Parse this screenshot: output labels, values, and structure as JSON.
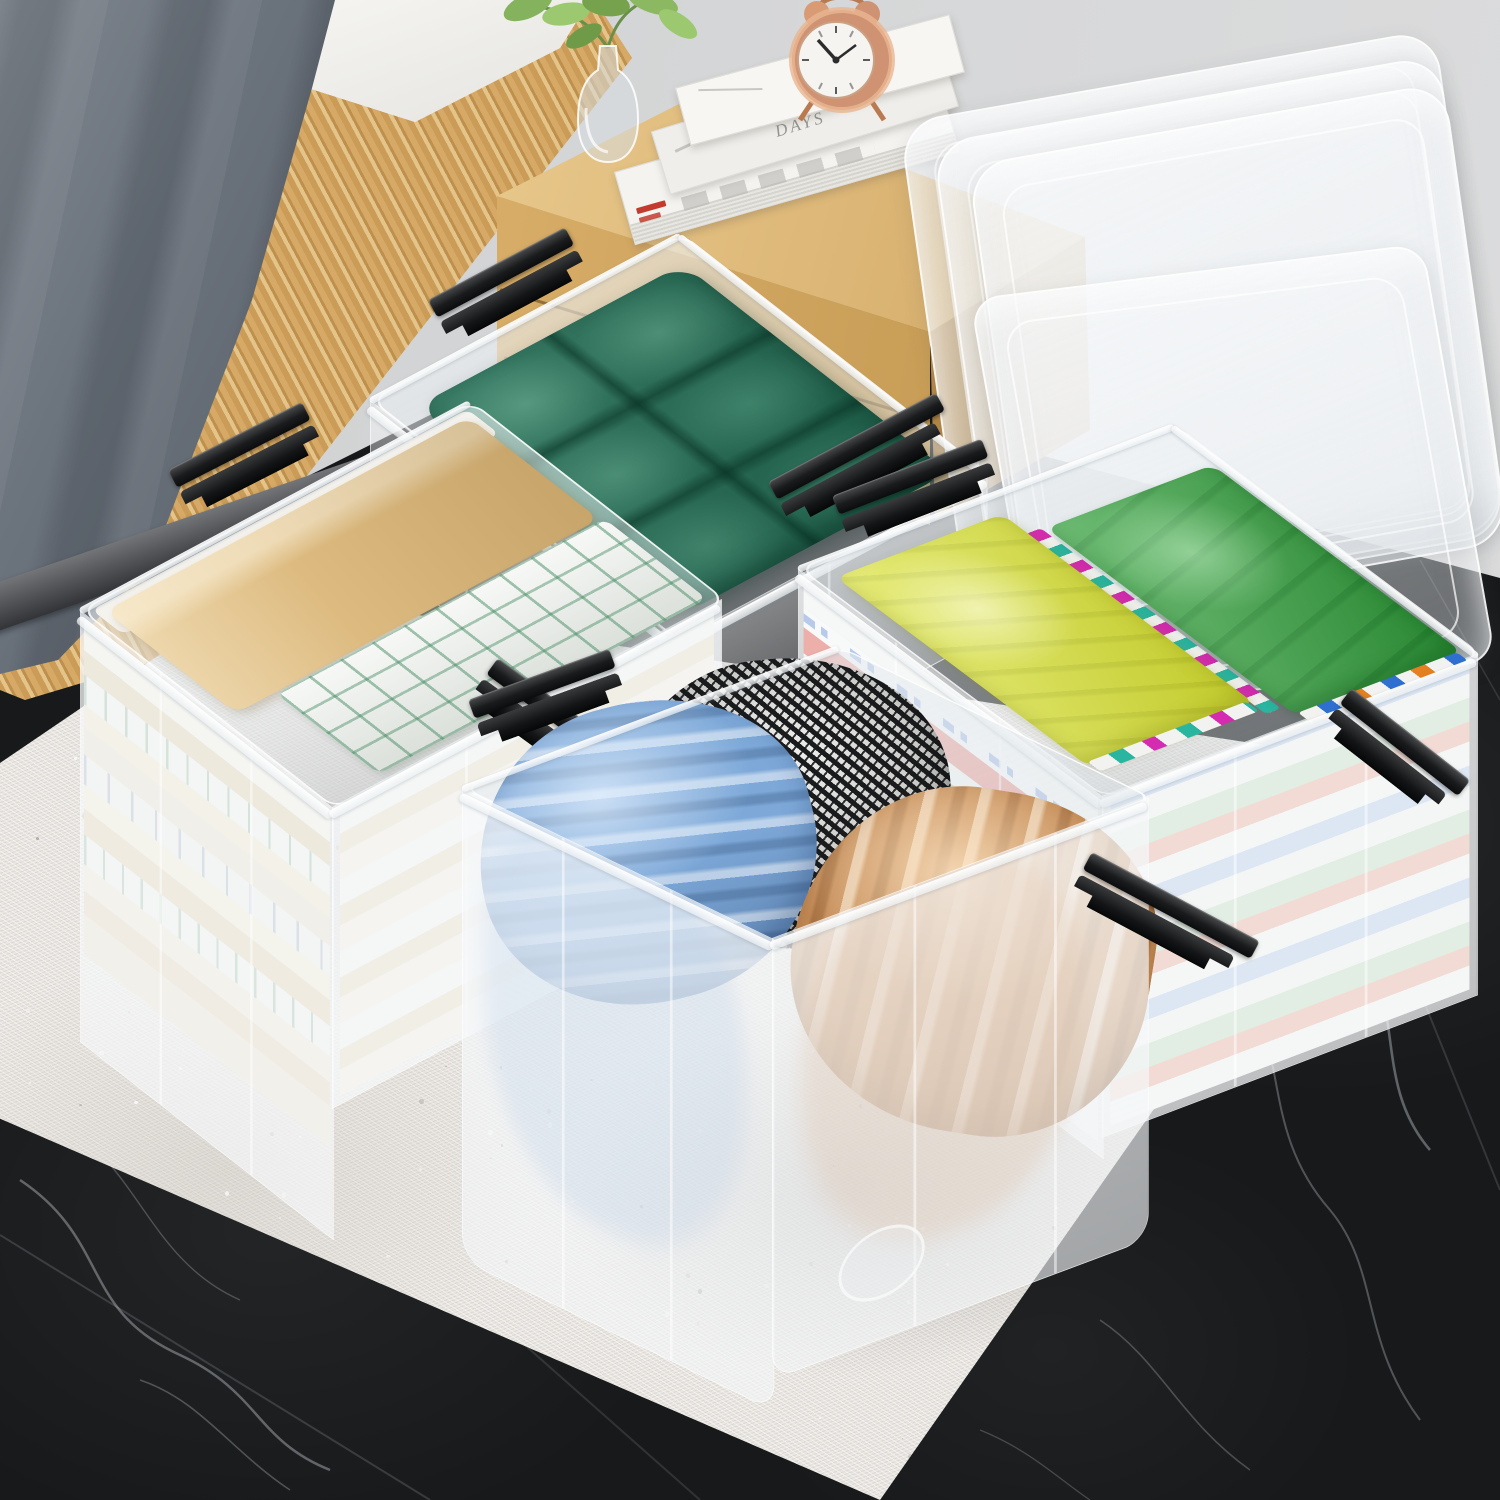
{
  "scene": {
    "title": "Four clear plastic storage bins with black latch handles staged in a bedroom",
    "setting": "black marble floor, white shag rug, wood bed frame with gray blanket, wood nightstand",
    "lids": {
      "stacked_against_wall": 3,
      "open_behind_right_bin": 1
    }
  },
  "palette": {
    "wall": "#d6d7d8",
    "marble": "#17191b",
    "marble_vein": "#cdd3d7",
    "rug": "#eae7e3",
    "wood_frame": "#cfa35e",
    "wood_nightstand": "#dcb676",
    "blanket_gray": "#68707a",
    "mattress": "#f4f3f0",
    "stone_strip": "#55575a",
    "latch_black": "#1a1b1d",
    "cushion_green": "#1f6b52",
    "linen_beige": "#ddbb80",
    "plaid_green": "#4e8f6d",
    "shirt_yellow": "#d9e13a",
    "shirt_green": "#3aa043",
    "pillow_blue": "#7da8d8",
    "pillow_tan": "#c68d58",
    "houndstooth_base": "#ececea",
    "clock_copper": "#cf9273",
    "plant_green": "#85b35d"
  },
  "nightstand": {
    "books": {
      "spine_text": "DAYS",
      "accent_color": "#c23b2e",
      "count": 4
    },
    "clock": {
      "time": "10:09"
    },
    "vase": {
      "contents": "green sprigs"
    }
  },
  "bins": [
    {
      "id": "top",
      "contents": "dark green tufted cushion",
      "latches": 2
    },
    {
      "id": "left",
      "contents": "beige sheet, green plaid blanket, stacked folded linens",
      "latches": 2
    },
    {
      "id": "right",
      "contents": "folded shirt stacks: chartreuse-yellow and green, colorful layers",
      "latches": 2
    },
    {
      "id": "front",
      "contents": "ruched pillows: light blue, black-white houndstooth, tan",
      "latches": 2
    }
  ]
}
